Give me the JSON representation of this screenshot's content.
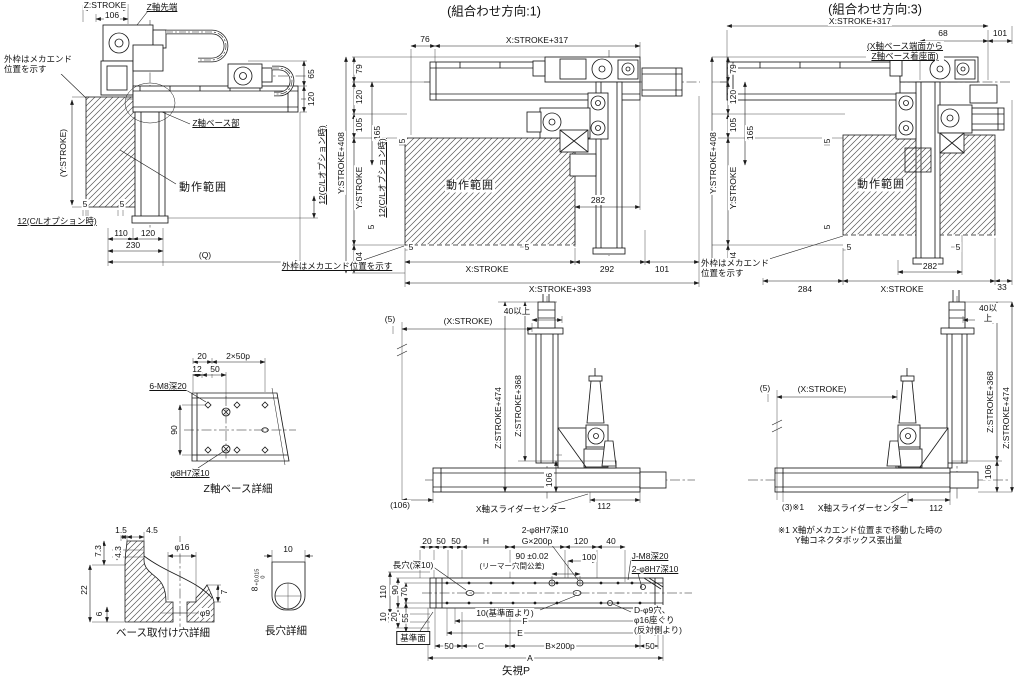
{
  "titles": {
    "dir1": "(組合わせ方向:1)",
    "dir3": "(組合わせ方向:3)",
    "view_p": "矢視P"
  },
  "side": {
    "z_stroke": "Z:STROKE",
    "d106": "106",
    "z_tip": "Z軸先端",
    "mech_note": "外枠はメカエンド\n位置を示す",
    "y_stroke": "(Y:STROKE)",
    "motion": "動作範囲",
    "z_base": "Z軸ベース部",
    "d5a": "5",
    "d5b": "5",
    "cl_opt": "12(C/Lオプション時)",
    "d110": "110",
    "d120": "120",
    "d230": "230",
    "q": "(Q)",
    "d65": "65",
    "d120r": "120",
    "cl_opt_r": "12(C/Lオプション時)"
  },
  "dir1": {
    "d76": "76",
    "x317": "X:STROKE+317",
    "y408": "Y:STROKE+408",
    "d79": "79",
    "d120": "120",
    "d105": "105",
    "d165": "165",
    "y_stroke": "Y:STROKE",
    "cl_opt": "12(C/Lオプション時)",
    "d104": "104",
    "d5_top": "5",
    "d5_left": "5",
    "motion": "動作範囲",
    "d282": "282",
    "d5b1": "5",
    "d5b2": "5",
    "x_stroke": "X:STROKE",
    "d292": "292",
    "d101": "101",
    "x393": "X:STROKE+393",
    "mech_note": "外枠はメカエンド位置を示す"
  },
  "dir3": {
    "x317": "X:STROKE+317",
    "d68": "68",
    "d101": "101",
    "base_note": "(X軸ベース端面から\nZ軸ベース着座面)",
    "y408": "Y:STROKE+408",
    "d79": "79",
    "d120": "120",
    "d105": "105",
    "d165": "165",
    "y_stroke": "Y:STROKE",
    "d104": "104",
    "d5_top": "5",
    "d5_left": "5",
    "motion": "動作範囲",
    "d282": "282",
    "d5b1": "5",
    "d5b2": "5",
    "mech_note": "外枠はメカエンド\n位置を示す",
    "d284": "284",
    "x_stroke": "X:STROKE",
    "d33": "33"
  },
  "elev1": {
    "d40": "40以上",
    "d5": "(5)",
    "x_stroke": "(X:STROKE)",
    "z474": "Z:STROKE+474",
    "z368": "Z:STROKE+368",
    "d106": "106",
    "d106p": "(106)",
    "slider_center": "X軸スライダーセンター",
    "d112": "112"
  },
  "elev3": {
    "d40": "40以上",
    "d5": "(5)",
    "x_stroke": "(X:STROKE)",
    "z368": "Z:STROKE+368",
    "z474": "Z:STROKE+474",
    "d106": "106",
    "d3": "(3)※1",
    "slider_center": "X軸スライダーセンター",
    "d112": "112",
    "note": "※1 X軸がメカエンド位置まで移動した時の\n　　Y軸コネクタボックス張出量"
  },
  "zbase": {
    "d20": "20",
    "p50": "2×50p",
    "d12": "12",
    "d50": "50",
    "m8": "6-M8深20",
    "d90": "90",
    "h7": "φ8H7深10",
    "caption": "Z軸ベース詳細"
  },
  "bmount": {
    "d15": "1.5",
    "d45": "4.5",
    "d73": "7.3",
    "d43": "4.3",
    "d22": "22",
    "d6": "6",
    "dia16": "φ16",
    "d7": "7",
    "dia9": "φ9",
    "caption": "ベース取付け穴詳細"
  },
  "slot": {
    "d10": "10",
    "tol_base": "8",
    "tol_hi": "+0.015",
    "tol_lo": "0",
    "caption": "長穴詳細"
  },
  "viewp": {
    "h7_top": "2-φ8H7深10",
    "d20": "20",
    "d50a": "50",
    "d50b": "50",
    "h": "H",
    "g200": "G×200p",
    "d120": "120",
    "d40": "40",
    "d90tol": "90 ±0.02",
    "reamer_note": "(リーマー穴間公差)",
    "d100": "100",
    "jm8": "J-M8深20",
    "h7r": "2-φ8H7深10",
    "slot_label": "長穴(深10)",
    "d110": "110",
    "d90": "90",
    "d70": "70",
    "d10": "10",
    "d20b": "20",
    "d55": "55",
    "datum": "基準面",
    "d10_datum": "10(基準面より)",
    "f": "F",
    "e": "E",
    "c": "C",
    "b200": "B×200p",
    "a": "A",
    "d50c": "50",
    "d50d": "50",
    "d9_note": "D-φ9穴、\nφ16座ぐり\n(反対側より)"
  }
}
